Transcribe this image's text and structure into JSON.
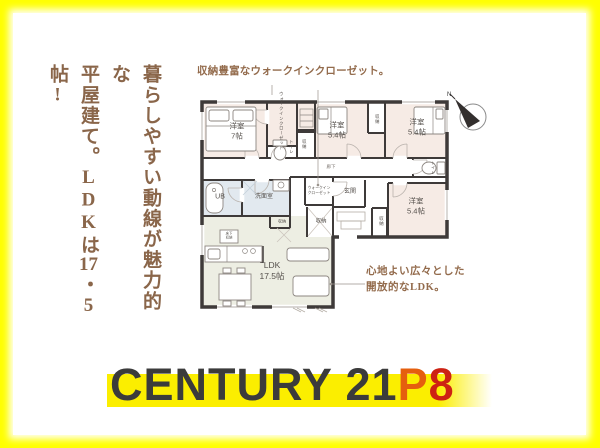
{
  "colors": {
    "border_yellow": "#ffff00",
    "panel_white": "#ffffff",
    "headline_brown": "#8a664a",
    "note_brown": "#936b4c",
    "wall": "#3e3a39",
    "room_fill": "#f6ebe5",
    "ldk_fill": "#edeee3",
    "bath_fill": "#e2e9ef",
    "label_gray": "#55504c",
    "logo_strip": "#fbee00",
    "logo_brand": "#3b3b3b",
    "logo_p": "#e55f0e",
    "logo_8": "#cd2213"
  },
  "headline": {
    "line1": "暮らしやすい動線が魅力的な",
    "line2_pre": "平屋建て。LDKは",
    "line2_tcy": "17",
    "line2_post": "・5帖!"
  },
  "notes": {
    "top": "収納豊富なウォークインクローゼット。",
    "bottom_line1": "心地よい広々とした",
    "bottom_line2": "開放的なLDK。"
  },
  "plan": {
    "compass_n": "N",
    "labels": {
      "bedroom7_name": "洋室",
      "bedroom7_size": "7帖",
      "bedroom_name": "洋室",
      "bedroom_size": "5.4帖",
      "wic": "ウォークインクローゼット",
      "toilet": "トイレ",
      "storage": "収納",
      "hallway": "廊下",
      "ub": "UB",
      "washroom": "洗面室",
      "wic2_line1": "ウォークイン",
      "wic2_line2": "クローゼット",
      "entrance": "玄関",
      "underfloor_line1": "床下",
      "underfloor_line2": "収納",
      "ldk_name": "LDK",
      "ldk_size": "17.5帖"
    }
  },
  "logo": {
    "brand": "CENTURY 21",
    "suffix_p": "P",
    "suffix_8": "8"
  }
}
